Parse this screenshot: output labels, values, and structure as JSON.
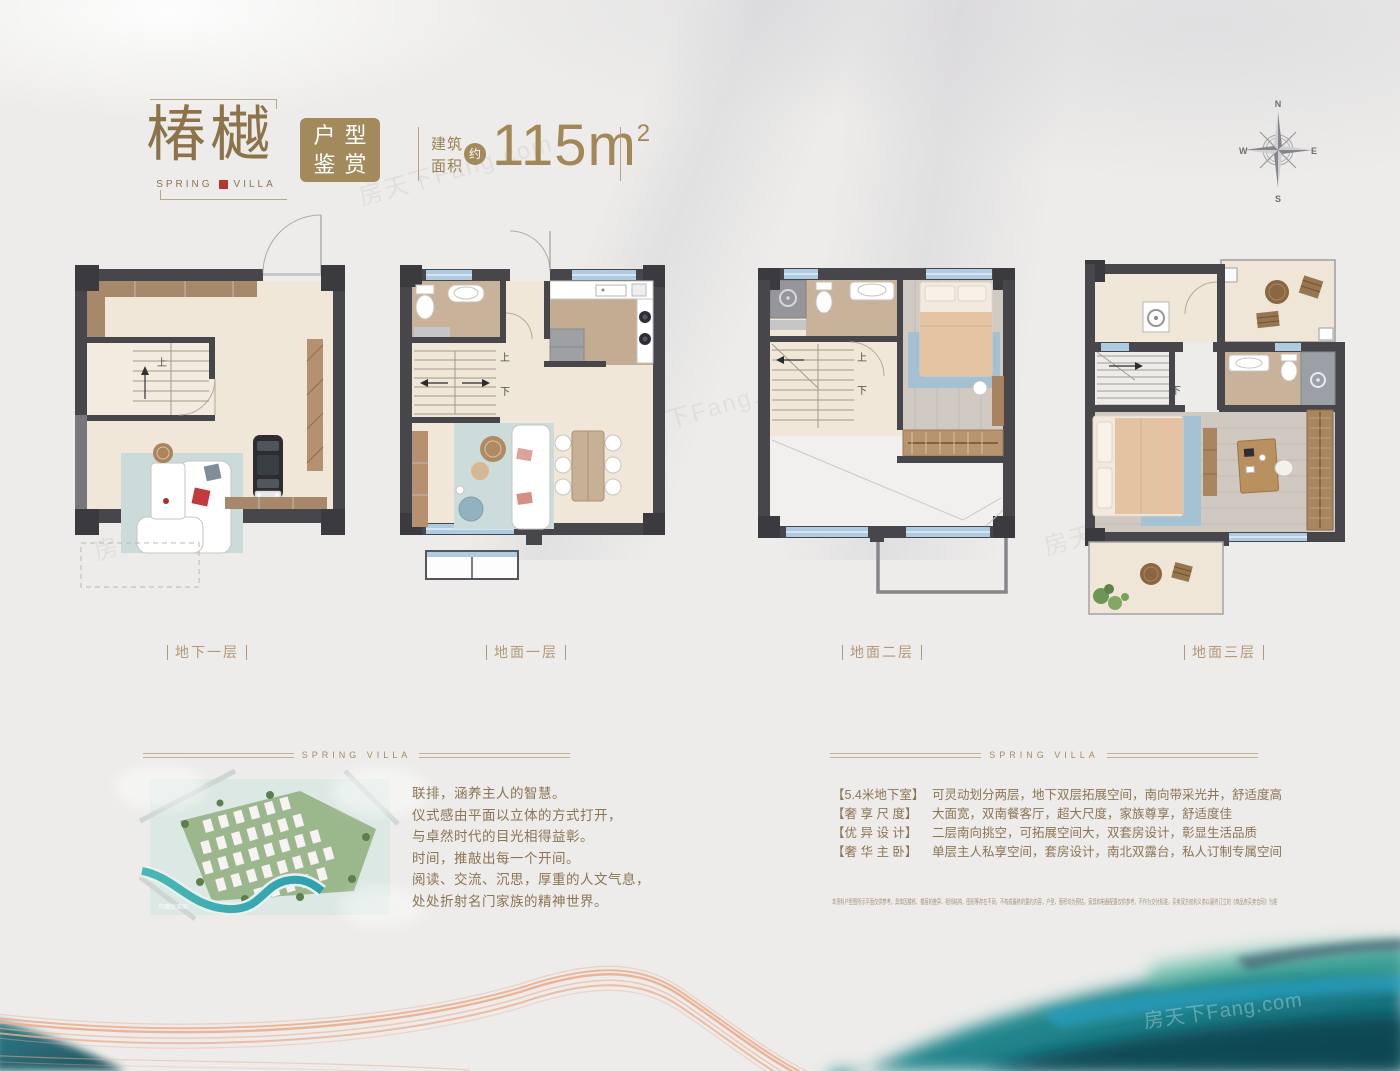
{
  "page": {
    "watermark": "房天下Fang.com"
  },
  "header": {
    "title": "椿樾",
    "subtitle_left": "SPRING",
    "subtitle_right": "VILLA",
    "badge_line1": "户型",
    "badge_line2": "鉴赏",
    "area_label_line1": "建筑",
    "area_label_line2": "面积",
    "area_approx": "约",
    "area_value": "115m",
    "area_sup": "2"
  },
  "compass": {
    "north": "N",
    "east": "E",
    "south": "S",
    "west": "W"
  },
  "floor_plans": [
    {
      "label": "地下一层",
      "stair_up": "上"
    },
    {
      "label": "地面一层",
      "stair_up": "上",
      "stair_down": "下"
    },
    {
      "label": "地面二层",
      "stair_up": "上",
      "stair_down": "下"
    },
    {
      "label": "地面三层",
      "stair_down": "下"
    }
  ],
  "intro": {
    "divider_label": "SPRING VILLA",
    "image_caption": "鸟瞰效果图",
    "lines": [
      "联排，涵养主人的智慧。",
      "仪式感由平面以立体的方式打开，",
      "与卓然时代的目光相得益彰。",
      "时间，推敲出每一个开间。",
      "阅读、交流、沉思，厚重的人文气息，",
      "处处折射名门家族的精神世界。"
    ]
  },
  "features": {
    "divider_label": "SPRING VILLA",
    "items": [
      {
        "tag": "【5.4米地下室】",
        "desc": "可灵动划分两层，地下双层拓展空间，南向带采光井，舒适度高"
      },
      {
        "tag": "【奢 享 尺 度】",
        "desc": "大面宽，双南餐客厅，超大尺度，家族尊享，舒适度佳"
      },
      {
        "tag": "【优 异 设 计】",
        "desc": "二层南向挑空，可拓展空间大，双套房设计，彰显生活品质"
      },
      {
        "tag": "【奢 华 主 卧】",
        "desc": "单层主人私享空间，套房设计，南北双露台，私人订制专属空间"
      }
    ],
    "disclaimer": "本资料户型图所示平面仅供参考，具体因楼栋、楼层的差异、相邻结构、图形等存在不同，不构成最终的要约内容，户型、面积均为预估，家具和电器配置仅供参考，不作为交付标准，买卖双方权利义务以最终订立的《商品房买卖合同》为准"
  }
}
